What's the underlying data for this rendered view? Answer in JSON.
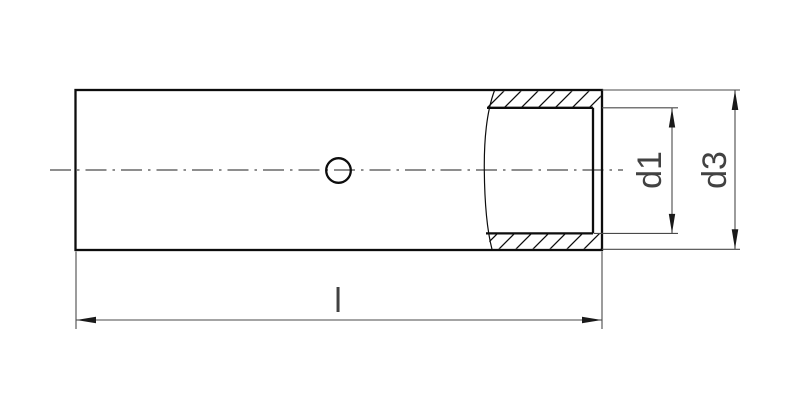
{
  "drawing": {
    "type": "technical-drawing",
    "subject": "tube-sleeve-connector-side-view-with-partial-section",
    "dimension_labels": {
      "length": "l",
      "inner_diameter": "d1",
      "outer_diameter": "d3"
    },
    "features": [
      "part-body-outline",
      "horizontal-centerline",
      "inspection-hole",
      "partial-section-break-line",
      "section-hatching-top-wall",
      "section-hatching-bottom-wall",
      "bore-end-edge"
    ],
    "colors": {
      "background": "#ffffff",
      "outline": "#0d0d0d",
      "thin_line": "#4a4a4a",
      "arrow": "#1a1a1a",
      "label": "#424242"
    }
  }
}
